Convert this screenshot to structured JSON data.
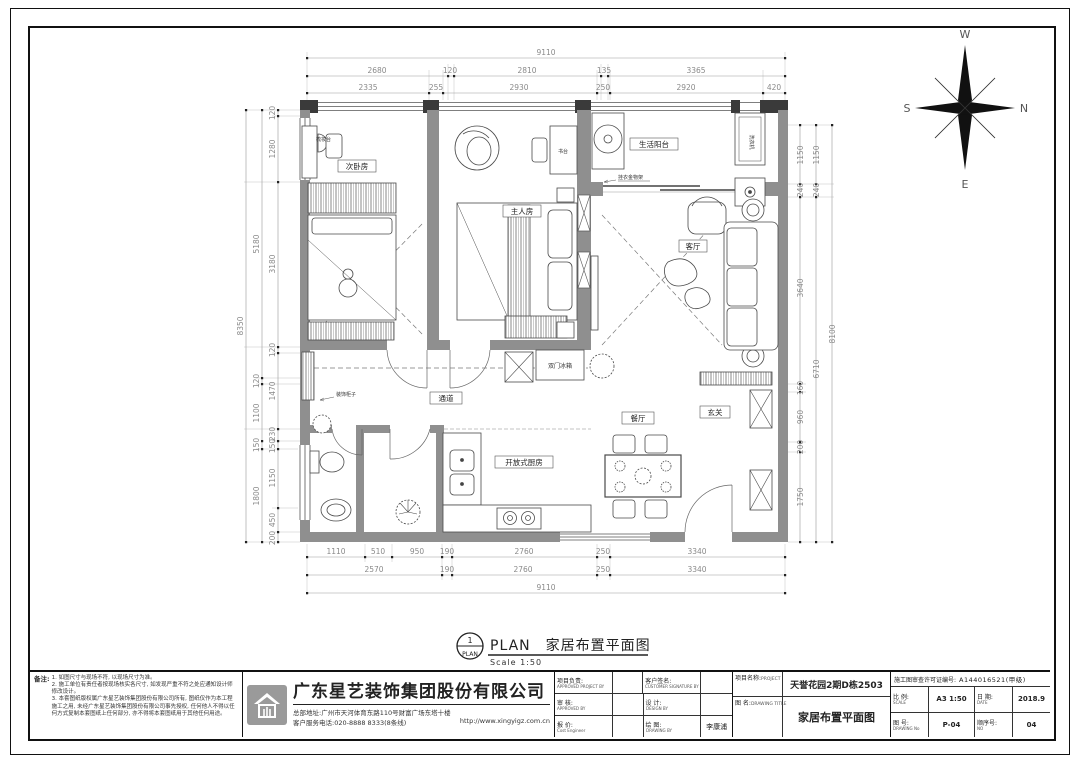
{
  "compass": {
    "top": "W",
    "right": "N",
    "left": "S",
    "bottom": "E"
  },
  "rooms": {
    "bedroom2": "次卧房",
    "master": "主人房",
    "balcony": "生活阳台",
    "living": "客厅",
    "corridor": "通道",
    "dining": "餐厅",
    "foyer": "玄关",
    "kitchen": "开放式厨房",
    "desk": "书台",
    "dresser": "梳妆台",
    "fridge": "双门冰箱",
    "washer": "洗衣机",
    "deco_cabinet": "装饰柜子",
    "rack": "挂衣金物架"
  },
  "dims": {
    "top": {
      "total": "9110",
      "row2": [
        "2680",
        "120",
        "2810",
        "135",
        "3365"
      ],
      "row3": [
        "2335",
        "255",
        "2930",
        "250",
        "2920",
        "420"
      ]
    },
    "bottom": {
      "row1": [
        "1110",
        "510",
        "950",
        "190",
        "2760",
        "250",
        "3340"
      ],
      "row2": [
        "2570",
        "190",
        "2760",
        "250",
        "3340"
      ],
      "total": "9110"
    },
    "left": {
      "outer": "8350",
      "middle": [
        "5180",
        "120",
        "1100",
        "150",
        "1800"
      ],
      "inner": [
        "120",
        "1280",
        "3180",
        "120",
        "1470",
        "230",
        "150",
        "1150",
        "450",
        "200"
      ]
    },
    "right": {
      "outer": "8100",
      "middle": [
        "1150",
        "240",
        "6710"
      ],
      "inner": [
        "1150",
        "240",
        "3640",
        "160",
        "960",
        "200",
        "1750"
      ]
    }
  },
  "plan_title": {
    "number": "1",
    "circle_label": "PLAN",
    "heading": "PLAN　家居布置平面图",
    "scale": "Scale 1:50"
  },
  "titleblock": {
    "notes_label": "备注:",
    "notes": [
      "1. 如图尺寸与现场不符, 以现场尺寸为准。",
      "2. 施工单位有责任者按现场核实各尺寸, 如发现严重不符之处应通知设计师修改设计。",
      "3. 本套图纸版权属广东星艺装饰集团股份有限公司所有, 图纸仅作为本工程施工之用, 未经广东星艺装饰集团股份有限公司事先授权, 任何他人不得以任何方式复制本套图纸上任何部分, 亦不得将本套图纸用于其他任何用途。"
    ],
    "company": {
      "name": "广东星艺装饰集团股份有限公司",
      "address": "总部地址:广州市天河体育东路110号财富广场东塔十楼",
      "phone": "客户服务电话:020-8888 8333(8条线)",
      "website": "http://www.xingyigz.com.cn"
    },
    "fields": {
      "approved_project": {
        "cn": "项目负责:",
        "en": "APPROVED PROJECT BY",
        "value": ""
      },
      "customer_sign": {
        "cn": "客户签名:",
        "en": "CUSTOMER SIGNATURE BY",
        "value": ""
      },
      "approved": {
        "cn": "审 核:",
        "en": "APPROVED BY",
        "value": ""
      },
      "design": {
        "cn": "设 计:",
        "en": "DESIGN BY",
        "value": ""
      },
      "quote": {
        "cn": "报 价:",
        "en": "Cost Engineer",
        "value": ""
      },
      "drawing_by": {
        "cn": "绘 图:",
        "en": "DRAWING BY",
        "value": "李康浦"
      }
    },
    "project": {
      "cn": "项目名称:",
      "en": "PROJECT",
      "value": "天誉花园2期D栋2503"
    },
    "drawing_title": {
      "cn": "图 名:",
      "en": "DRAWING TITLE",
      "value": "家居布置平面图"
    },
    "permit": {
      "label": "施工图审查许可证编号:",
      "value": "A144016521(甲级)"
    },
    "scale": {
      "cn": "比 例:",
      "en": "SCALE",
      "value": "A3 1:50"
    },
    "date": {
      "cn": "日 期:",
      "en": "DATE",
      "value": "2018.9"
    },
    "drawing_no": {
      "cn": "图 号:",
      "en": "DRAWING No",
      "value": "P-04"
    },
    "seq_no": {
      "cn": "顺序号:",
      "en": "NO",
      "value": "04"
    }
  }
}
